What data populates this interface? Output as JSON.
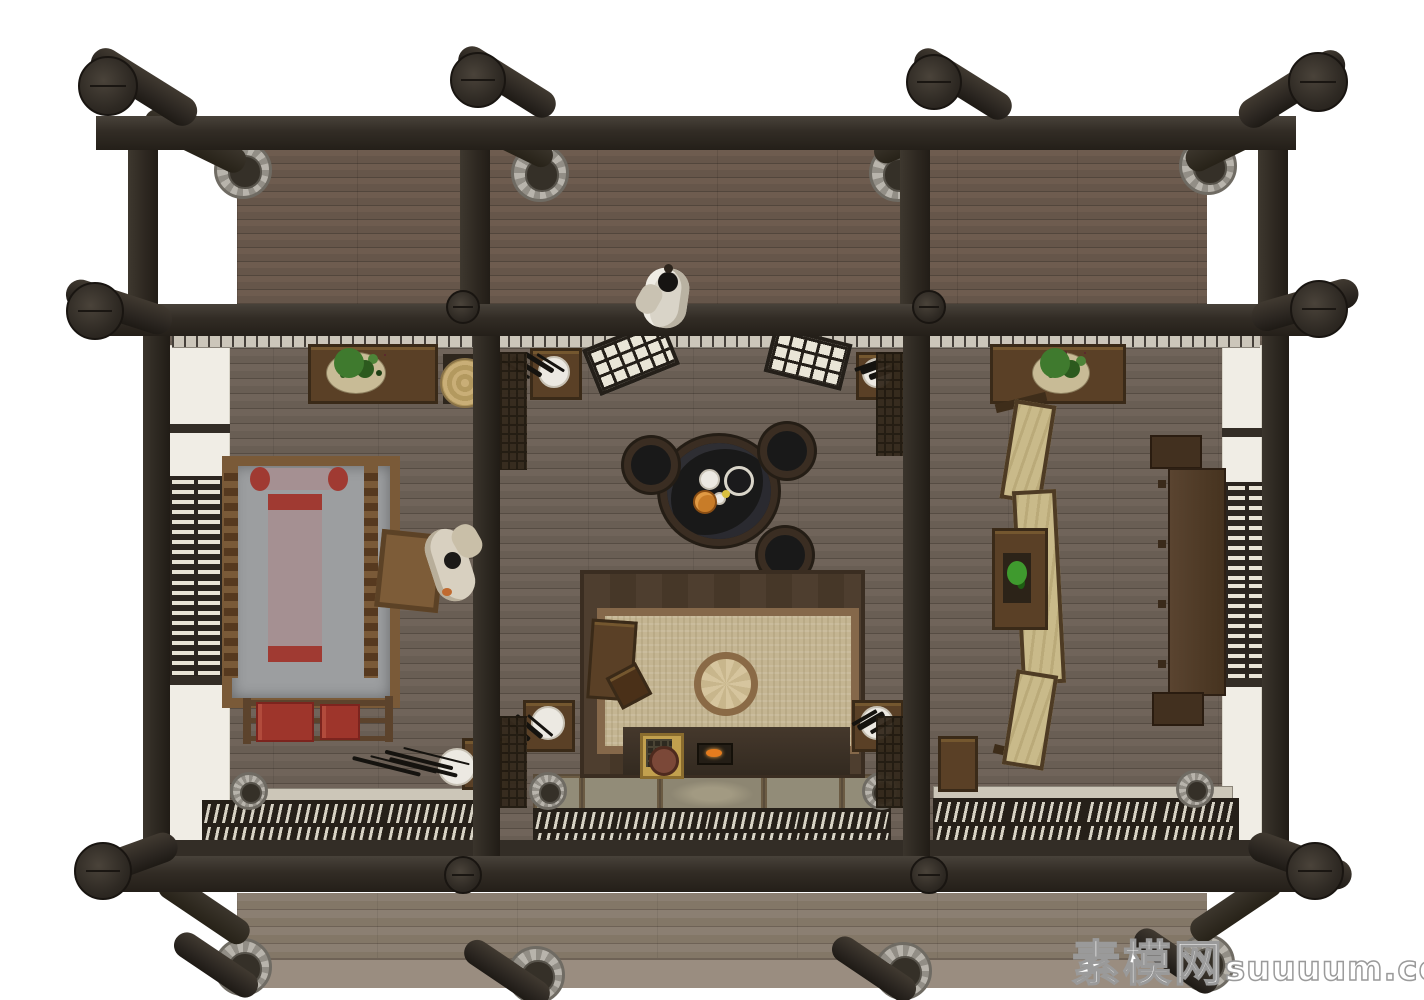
{
  "scene": {
    "description": "top-down 3D render of a traditional Chinese timber-frame house interior with three rooms",
    "watermark": {
      "cn": "素模网",
      "en": "suuuum.com"
    },
    "structure": {
      "timber_color": "#322c25",
      "stone_base_color": "#b8b4ac",
      "floor_plank_color": "#6e635a",
      "porch_plank_color": "#8b7f72",
      "wall_plaster_color": "#f0ede5",
      "lattice_slat_color": "#e9e4d6"
    },
    "rooms": {
      "left": [
        "lattice-window",
        "canopy-bed",
        "bedding-roll",
        "bolster-pillow",
        "bedside-table",
        "person",
        "plant-cabinet",
        "straw-hat",
        "clothes-rack",
        "red-garments",
        "vase-with-plum-branch"
      ],
      "center": [
        "person-on-veranda",
        "open-lattice-doors",
        "bonsai-tables",
        "fire-pit-with-dishes",
        "charcoal-braziers",
        "tea-platform",
        "woven-mat",
        "round-cushion",
        "side-cabinet",
        "hearth-stove",
        "fire-box",
        "tatami-mats",
        "lattice-door-row"
      ],
      "right": [
        "plant-cabinet",
        "folding-screen",
        "bonsai-stand",
        "writing-desk",
        "stools",
        "lattice-window",
        "small-cabinet"
      ]
    },
    "accents": {
      "bedding_red": "#a03a32",
      "screen_paper": "#c9ba8a",
      "mat_tan": "#c4b592",
      "fire_orange": "#e67c1e",
      "plant_green": "#3f7a2e"
    }
  }
}
